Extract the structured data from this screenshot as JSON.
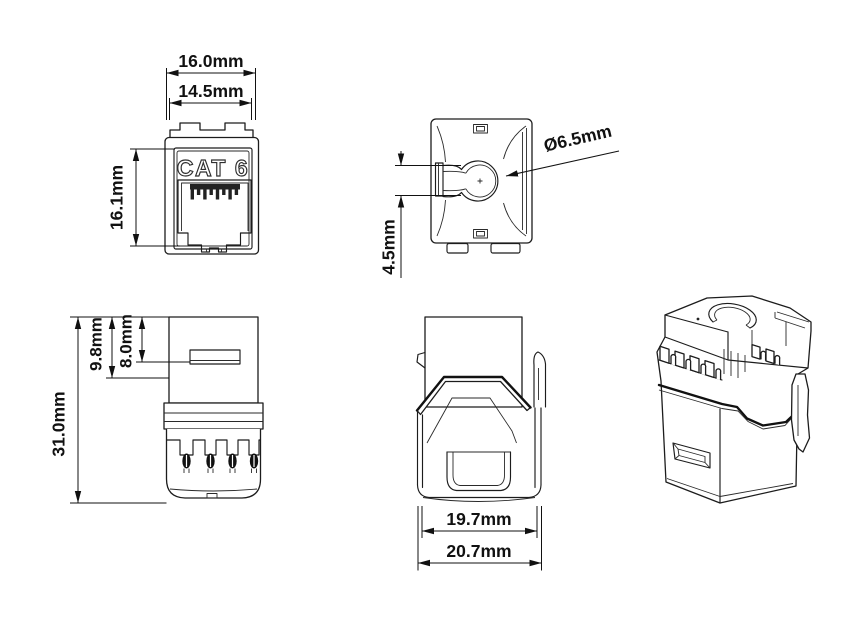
{
  "labels": {
    "front_width_outer": "16.0mm",
    "front_width_inner": "14.5mm",
    "front_height": "16.1mm",
    "marking": "CAT 6",
    "hole_diameter": "Ø6.5mm",
    "hole_offset": "4.5mm",
    "total_height": "31.0mm",
    "rear_depth_a": "9.8mm",
    "rear_depth_b": "8.0mm",
    "side_width_inner": "19.7mm",
    "side_width_outer": "20.7mm"
  },
  "colors": {
    "line": "#1c1c1c",
    "text": "#111111",
    "background": "#ffffff"
  }
}
